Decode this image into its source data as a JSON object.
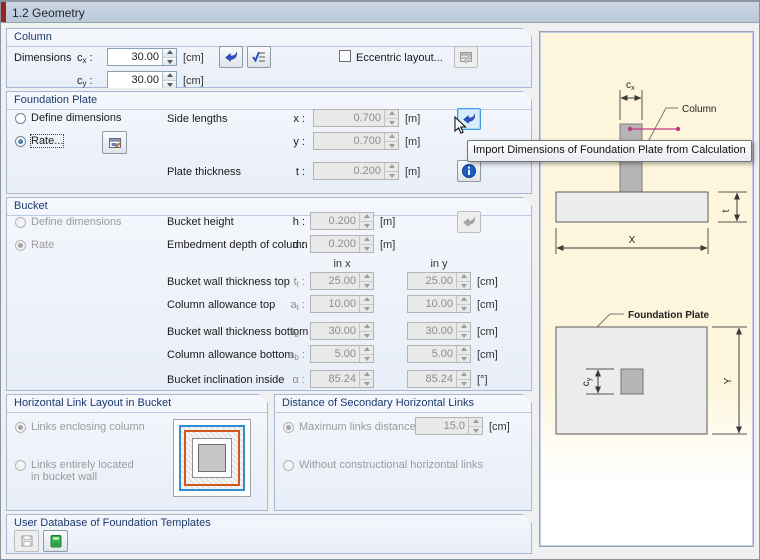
{
  "header": {
    "title": "1.2 Geometry"
  },
  "column": {
    "title": "Column",
    "dimensions_label": "Dimensions",
    "cx": {
      "base": "c",
      "sub": "x",
      "colon": " :",
      "value": "30.00",
      "unit": "[cm]"
    },
    "cy": {
      "base": "c",
      "sub": "y",
      "colon": " :",
      "value": "30.00",
      "unit": "[cm]"
    },
    "eccentric_label": "Eccentric layout..."
  },
  "foundation_plate": {
    "title": "Foundation Plate",
    "define_dimensions_label": "Define dimensions",
    "rate_label": "Rate...",
    "side_lengths_label": "Side lengths",
    "plate_thickness_label": "Plate thickness",
    "x": {
      "label": "x :",
      "value": "0.700",
      "unit": "[m]"
    },
    "y": {
      "label": "y :",
      "value": "0.700",
      "unit": "[m]"
    },
    "t": {
      "label": "t :",
      "value": "0.200",
      "unit": "[m]"
    }
  },
  "bucket": {
    "title": "Bucket",
    "define_dimensions_label": "Define dimensions",
    "rate_label": "Rate",
    "height_label": "Bucket height",
    "h": {
      "label": "h :",
      "value": "0.200",
      "unit": "[m]"
    },
    "embedment_label": "Embedment depth of column",
    "d": {
      "label": "d :",
      "value": "0.200",
      "unit": "[m]"
    },
    "col_x": "in x",
    "col_y": "in y",
    "rows": [
      {
        "label": "Bucket wall thickness top",
        "base": "t",
        "sub": "t",
        "colon": " :",
        "vx": "25.00",
        "vy": "25.00",
        "unit": "[cm]"
      },
      {
        "label": "Column allowance top",
        "base": "a",
        "sub": "t",
        "colon": " :",
        "vx": "10.00",
        "vy": "10.00",
        "unit": "[cm]"
      },
      {
        "label": "Bucket wall thickness bottom",
        "base": "t",
        "sub": "b",
        "colon": " :",
        "vx": "30.00",
        "vy": "30.00",
        "unit": "[cm]"
      },
      {
        "label": "Column allowance bottom",
        "base": "a",
        "sub": "b",
        "colon": " :",
        "vx": "5.00",
        "vy": "5.00",
        "unit": "[cm]"
      },
      {
        "label": "Bucket inclination inside",
        "base": "α",
        "sub": "",
        "colon": " :",
        "vx": "85.24",
        "vy": "85.24",
        "unit": "[°]"
      }
    ]
  },
  "link_layout": {
    "title": "Horizontal Link Layout in Bucket",
    "radio_enclosing": "Links enclosing column",
    "radio_wall_line1": "Links entirely located",
    "radio_wall_line2": "in bucket wall"
  },
  "secondary_links": {
    "title": "Distance of Secondary Horizontal Links",
    "radio_max": "Maximum links distance",
    "max": {
      "value": "15.0",
      "unit": "[cm]"
    },
    "radio_without": "Without constructional horizontal links"
  },
  "user_db": {
    "title": "User Database of Foundation Templates"
  },
  "tooltip": {
    "text": "Import Dimensions of Foundation Plate from Calculation"
  },
  "diagram": {
    "column_label": "Column",
    "plate_label": "Foundation Plate",
    "cx": {
      "base": "c",
      "sub": "x"
    },
    "cy": {
      "base": "c",
      "sub": "y"
    },
    "t": "t",
    "x": "X",
    "y": "Y"
  }
}
